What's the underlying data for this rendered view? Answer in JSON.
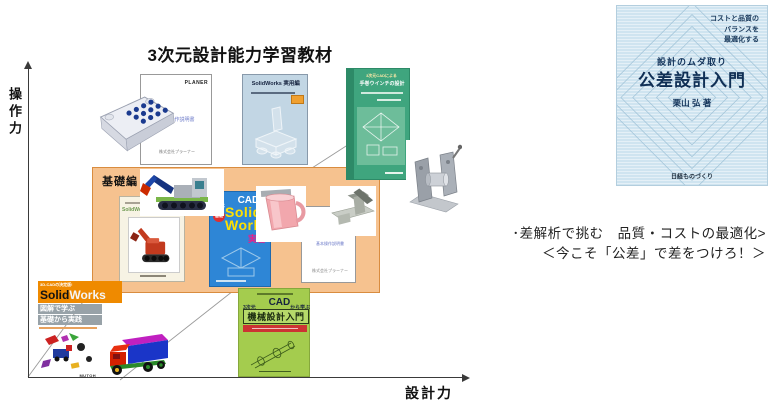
{
  "page": {
    "title": "3次元設計能力学習教材",
    "y_axis": "操作力",
    "x_axis": "設計力"
  },
  "basics": {
    "label": "基礎編"
  },
  "books": {
    "planer": {
      "brand": "PLANER",
      "title": "基本操作説明書",
      "footer": "株式会社プラーナー"
    },
    "sw_practical": {
      "title": "SolidWorks 実用編"
    },
    "winch": {
      "header": "3次元CADによる",
      "title": "手巻ウインチの設計"
    },
    "sw_hen": {
      "title": "SolidWorks編"
    },
    "cad_master": {
      "pre": "3次元",
      "big": "CAD",
      "post": "完全マスター",
      "badge": "基礎",
      "line1": "Solid",
      "line2": "Works",
      "sub": "実習"
    },
    "manual2": {
      "title": "基本操作説明書",
      "footer": "株式会社プラーナー"
    },
    "mutoh": {
      "header": "3D-CADの決定版!",
      "title1": "Solid",
      "title2": "Works",
      "band1": "図解で学ぶ",
      "band2": "基礎から実践",
      "footer": "MUTOH"
    },
    "mech": {
      "pre": "3次元",
      "big": "CAD",
      "post": "から学ぶ",
      "title": "機械設計入門"
    },
    "tolerance": {
      "tag1": "コストと品質の",
      "tag2": "バランスを",
      "tag3": "最適化する",
      "series": "設計のムダ取り",
      "title": "公差設計入門",
      "author": "栗山 弘 著",
      "publisher": "日経ものづくり"
    }
  },
  "caption": {
    "line1": "･差解析で挑む　品質・コストの最適化>",
    "line2": "＜今こそ「公差」で差をつけろ！＞"
  },
  "colors": {
    "basics_box_fill": "#f6c28f",
    "basics_box_border": "#d98c3f",
    "winch_cover": "#3fa57e",
    "cad_master_cover": "#2e86d6",
    "mech_cover": "#a4cc4e",
    "tolerance_cover": "#cfe4f0",
    "mutoh_header": "#ef8a00",
    "sw_practical_cover": "#c2d6e4"
  }
}
